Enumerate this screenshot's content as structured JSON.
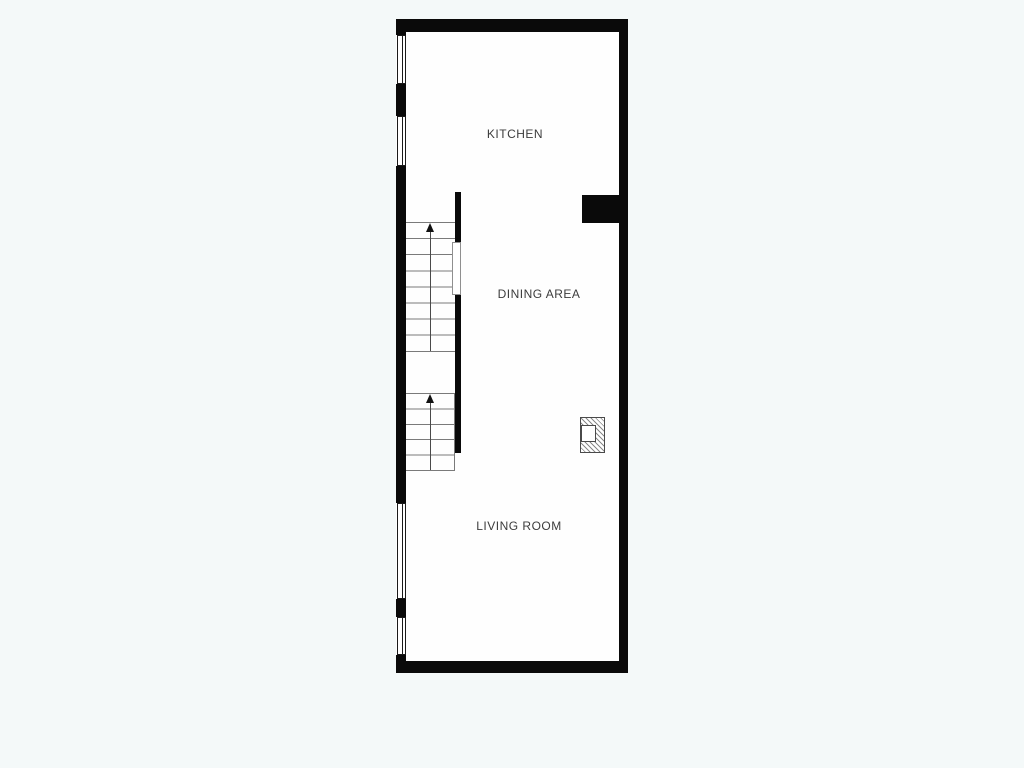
{
  "page": {
    "type": "floor-plan-drawing",
    "background_color": "#f4f9f9",
    "interior_color": "#fefefe"
  },
  "floor_plan": {
    "rooms": [
      {
        "id": "kitchen",
        "name": "KITCHEN"
      },
      {
        "id": "dining",
        "name": "DINING AREA"
      },
      {
        "id": "living",
        "name": "LIVING ROOM"
      }
    ],
    "features": {
      "staircase_upper": {
        "tread_lines": 9,
        "direction_arrow": "up"
      },
      "staircase_lower": {
        "tread_lines": 6,
        "direction_arrow": "up"
      },
      "windows_on_left_wall": 4,
      "interior_wall_opening": 1,
      "wall_pier_on_right_wall": 1,
      "fireplace_symbol": 1
    },
    "colors": {
      "wall": "#0a0a0a",
      "tread_line": "#7a7a7a",
      "label_text": "#3c3c3c",
      "hatch": "#8a8a8a"
    }
  }
}
